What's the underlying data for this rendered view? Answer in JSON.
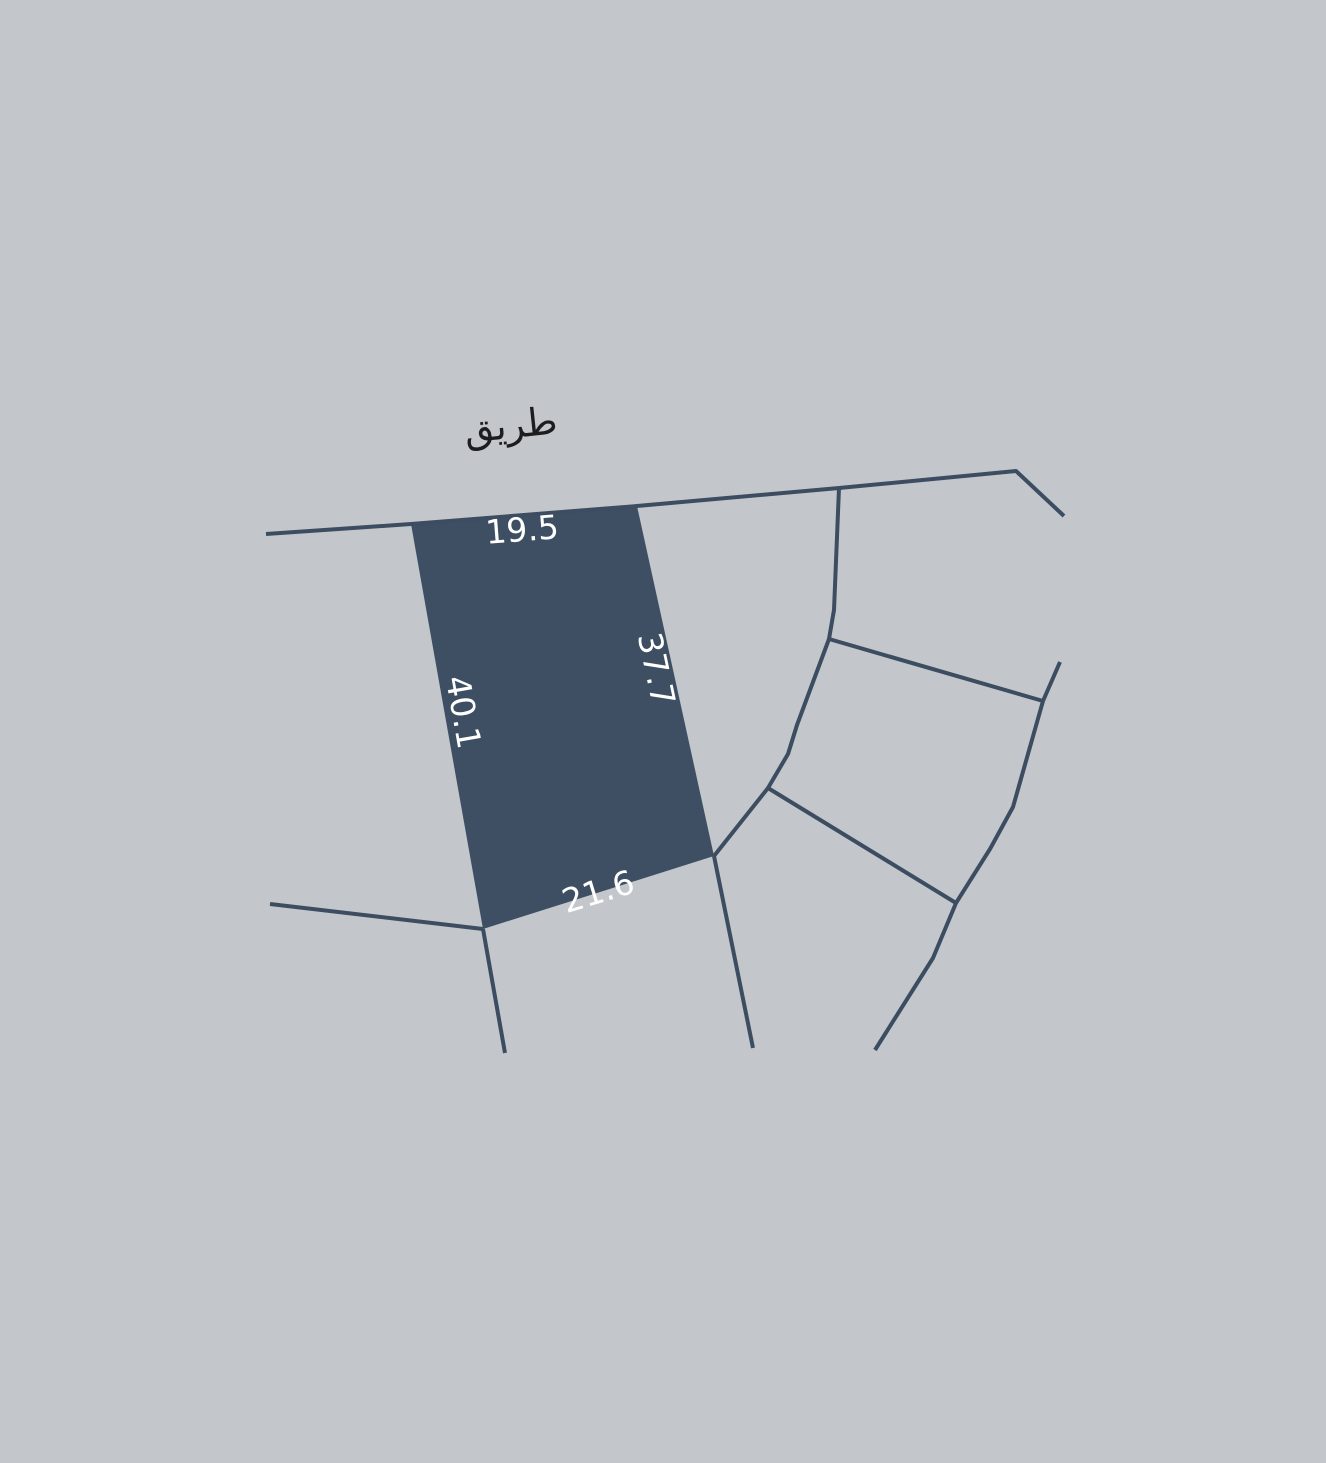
{
  "map": {
    "road_label": "طريق",
    "parcel": {
      "dim_top": "19.5",
      "dim_right": "37.7",
      "dim_left": "40.1",
      "dim_bottom": "21.6"
    },
    "colors": {
      "background": "#c3c7cb",
      "parcel_fill": "#3e4f63",
      "boundary_line": "#3c4d61",
      "dimension_text": "#ffffff",
      "road_label_text": "#1d1d1f"
    }
  }
}
